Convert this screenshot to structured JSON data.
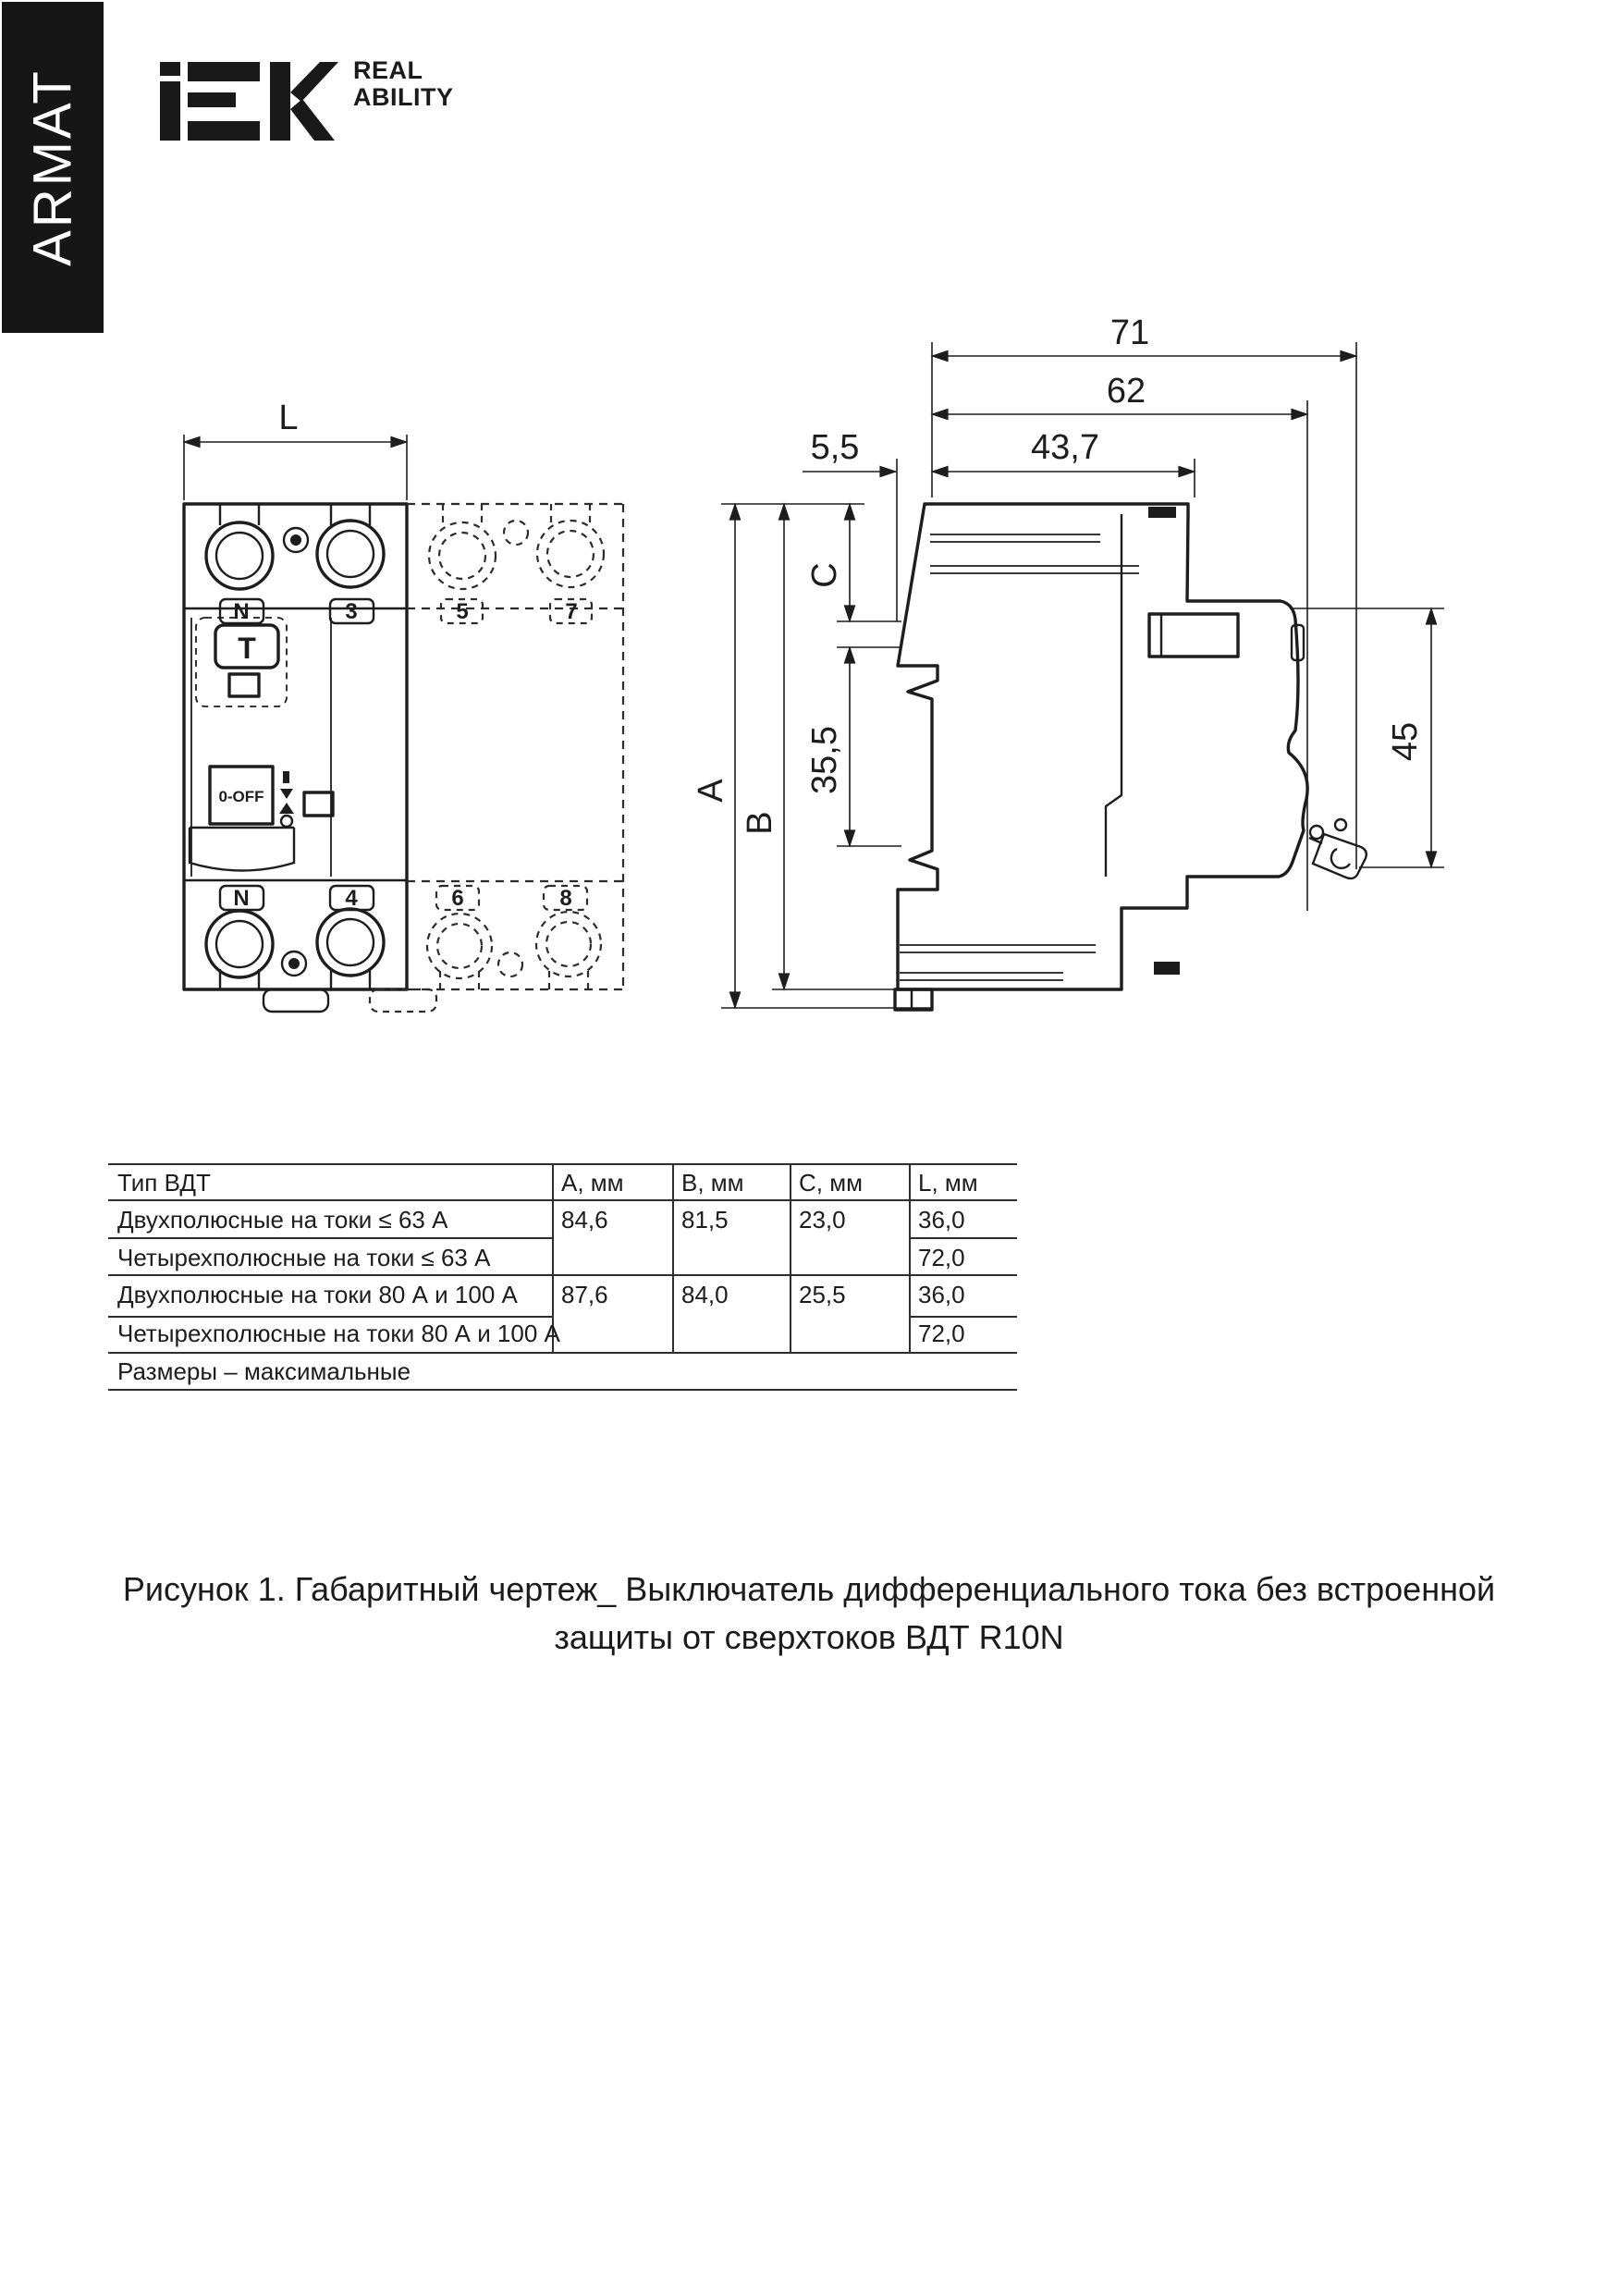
{
  "brand": {
    "banner_text": "ARMAT",
    "logo_name": "IEK",
    "tagline_line1": "REAL",
    "tagline_line2": "ABILITY"
  },
  "front_view": {
    "dim_width": "L",
    "terminal_top_left": "N",
    "terminal_top_right": "3",
    "terminal_top_ghost_left": "5",
    "terminal_top_ghost_right": "7",
    "terminal_bottom_left": "N",
    "terminal_bottom_right": "4",
    "terminal_bottom_ghost_left": "6",
    "terminal_bottom_ghost_right": "8",
    "test_button": "T",
    "switch_label": "0-OFF"
  },
  "side_view": {
    "dim_71": "71",
    "dim_62": "62",
    "dim_5_5": "5,5",
    "dim_43_7": "43,7",
    "dim_a": "A",
    "dim_b": "B",
    "dim_c": "C",
    "dim_35_5": "35,5",
    "dim_45": "45"
  },
  "table": {
    "headers": [
      "Тип ВДТ",
      "A, мм",
      "B, мм",
      "C, мм",
      "L, мм"
    ],
    "rows": [
      {
        "type": "Двухполюсные на токи ≤ 63 А",
        "a": "84,6",
        "b": "81,5",
        "c": "23,0",
        "l": "36,0"
      },
      {
        "type": "Четырехполюсные на токи ≤ 63 А",
        "a": "",
        "b": "",
        "c": "",
        "l": "72,0"
      },
      {
        "type": "Двухполюсные на токи 80 А и 100 А",
        "a": "87,6",
        "b": "84,0",
        "c": "25,5",
        "l": "36,0"
      },
      {
        "type": "Четырехполюсные на токи 80 А и 100 А",
        "a": "",
        "b": "",
        "c": "",
        "l": "72,0"
      }
    ],
    "footnote": "Размеры – максимальные"
  },
  "caption": {
    "line1": "Рисунок 1. Габаритный чертеж_ Выключатель дифференциального тока без встроенной",
    "line2": "защиты от сверхтоков ВДТ R10N"
  }
}
